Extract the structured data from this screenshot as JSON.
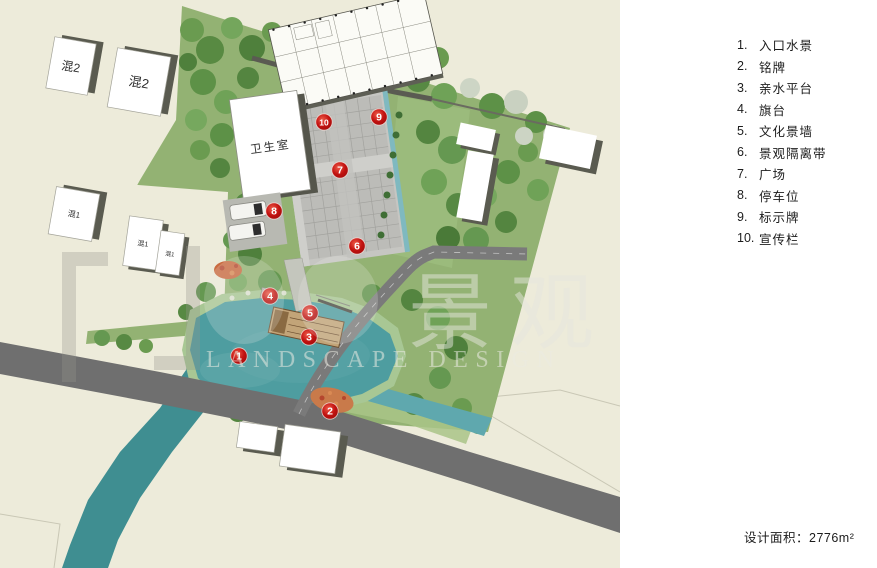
{
  "legend": {
    "items": [
      {
        "num": "1.",
        "label": "入口水景"
      },
      {
        "num": "2.",
        "label": "铭牌"
      },
      {
        "num": "3.",
        "label": "亲水平台"
      },
      {
        "num": "4.",
        "label": "旗台"
      },
      {
        "num": "5.",
        "label": "文化景墙"
      },
      {
        "num": "6.",
        "label": "景观隔离带"
      },
      {
        "num": "7.",
        "label": "广场"
      },
      {
        "num": "8.",
        "label": "停车位"
      },
      {
        "num": "9.",
        "label": "标示牌"
      },
      {
        "num": "10.",
        "label": "宣传栏"
      }
    ]
  },
  "area_note": "设计面积：2776m²",
  "map": {
    "buildings": {
      "hun2_a": "混2",
      "hun2_b": "混2",
      "hun1_a": "混1",
      "hun1_b": "混1",
      "hun1_c": "混1",
      "clinic": "卫生室"
    },
    "markers": [
      {
        "n": "1",
        "x": 239,
        "y": 356
      },
      {
        "n": "2",
        "x": 330,
        "y": 411
      },
      {
        "n": "3",
        "x": 309,
        "y": 337
      },
      {
        "n": "4",
        "x": 270,
        "y": 296
      },
      {
        "n": "5",
        "x": 310,
        "y": 313
      },
      {
        "n": "6",
        "x": 357,
        "y": 246
      },
      {
        "n": "7",
        "x": 340,
        "y": 170
      },
      {
        "n": "8",
        "x": 274,
        "y": 211
      },
      {
        "n": "9",
        "x": 379,
        "y": 117
      },
      {
        "n": "10",
        "x": 324,
        "y": 122
      }
    ],
    "watermark": {
      "cn": "景观",
      "en": "LANDSCAPE DESIGN"
    }
  },
  "colors": {
    "canvas_cream": "#edebda",
    "site_green": "#93b273",
    "road_gray": "#6f6f6f",
    "water_teal": "#4e9da0",
    "marker_red": "#c21210",
    "building_white": "#ffffff",
    "shadow_gray": "#5a5b50"
  }
}
